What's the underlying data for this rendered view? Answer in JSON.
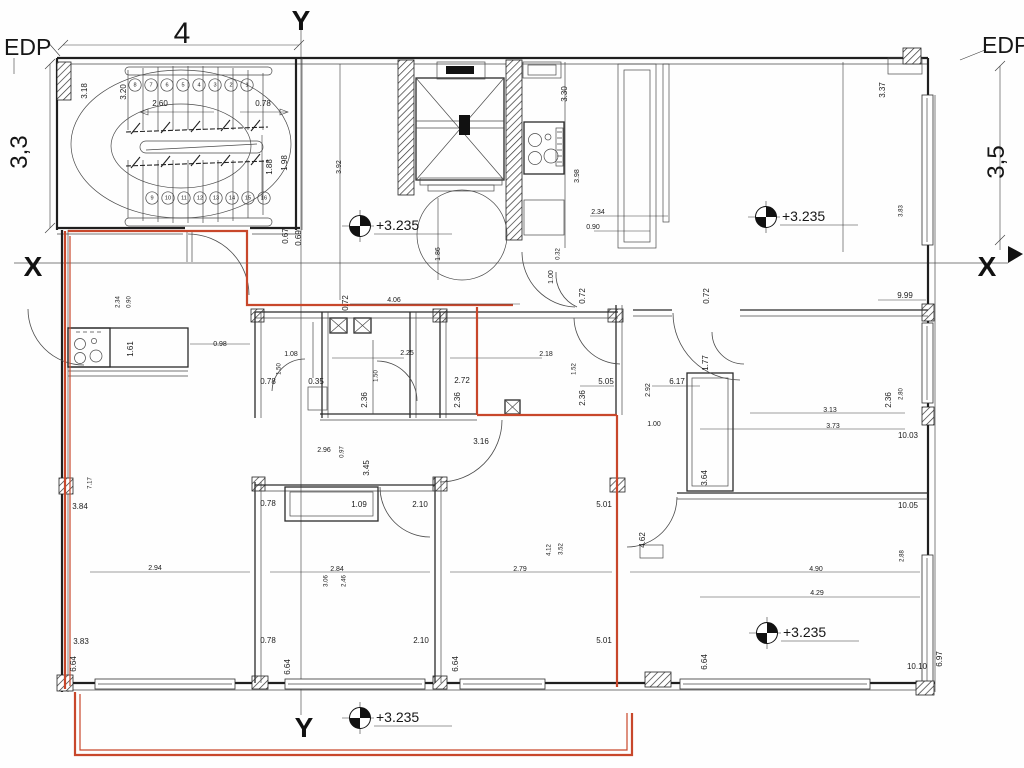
{
  "drawing": {
    "axis": {
      "y_top": "Y",
      "y_bottom": "Y",
      "x_left": "X",
      "x_right": "X"
    },
    "grid": {
      "edp_left": "EDP",
      "edp_right": "EDP",
      "width_top": "4",
      "height_left": "3,3",
      "height_right": "3,5"
    },
    "elevation": {
      "label": "+3.235",
      "markers": [
        [
          360,
          226
        ],
        [
          766,
          217
        ],
        [
          767,
          633
        ],
        [
          360,
          718
        ]
      ]
    },
    "stairs": {
      "top_row": [
        "8",
        "7",
        "6",
        "5",
        "4",
        "3",
        "2",
        "1"
      ],
      "bottom_row": [
        "9",
        "10",
        "11",
        "12",
        "13",
        "14",
        "15",
        "16"
      ]
    },
    "icon_legend": {
      "elevation_marker": "quartered-circle-survey-icon",
      "vent_shaft": "crossed-box-icon",
      "stove": "four-burner-stove-icon"
    },
    "colors": {
      "renovation_red": "#c8472b",
      "wall_black": "#1f1f1f"
    },
    "dimensions": [
      [
        "3.18",
        85,
        91,
        -90,
        8
      ],
      [
        "3.20",
        124,
        92,
        -90,
        8
      ],
      [
        "2.60",
        160,
        104,
        0,
        8
      ],
      [
        "0.78",
        263,
        104,
        0,
        8
      ],
      [
        "1.88",
        270,
        167,
        -90,
        8
      ],
      [
        "1.98",
        285,
        163,
        -90,
        8
      ],
      [
        "0.67",
        286,
        236,
        -90,
        8
      ],
      [
        "0.69",
        299,
        238,
        -90,
        8
      ],
      [
        "3.92",
        339,
        167,
        -90,
        7
      ],
      [
        "1.86",
        438,
        254,
        -90,
        7
      ],
      [
        "3.30",
        565,
        94,
        -90,
        8
      ],
      [
        "3.98",
        577,
        176,
        -90,
        7
      ],
      [
        "2.34",
        598,
        212,
        0,
        7
      ],
      [
        "0.90",
        593,
        227,
        0,
        7
      ],
      [
        "0.32",
        558,
        254,
        -90,
        6
      ],
      [
        "1.00",
        551,
        277,
        -90,
        7
      ],
      [
        "3.37",
        883,
        90,
        -90,
        8
      ],
      [
        "3.83",
        901,
        211,
        -90,
        6
      ],
      [
        "9.99",
        905,
        296,
        0,
        8
      ],
      [
        "0.72",
        346,
        303,
        -90,
        8
      ],
      [
        "4.06",
        394,
        300,
        0,
        7
      ],
      [
        "0.72",
        583,
        296,
        -90,
        8
      ],
      [
        "0.72",
        707,
        296,
        -90,
        8
      ],
      [
        "2.34",
        118,
        302,
        -90,
        6
      ],
      [
        "0.90",
        129,
        302,
        -90,
        6
      ],
      [
        "1.61",
        131,
        349,
        -90,
        8
      ],
      [
        "0.98",
        220,
        344,
        0,
        7
      ],
      [
        "1.08",
        291,
        354,
        0,
        7
      ],
      [
        "1.50",
        279,
        369,
        -90,
        6
      ],
      [
        "0.78",
        268,
        382,
        0,
        8
      ],
      [
        "0.35",
        316,
        382,
        0,
        8
      ],
      [
        "2.25",
        407,
        353,
        0,
        7
      ],
      [
        "1.50",
        376,
        376,
        -90,
        6
      ],
      [
        "2.36",
        365,
        400,
        -90,
        8
      ],
      [
        "2.72",
        462,
        381,
        0,
        8
      ],
      [
        "2.36",
        458,
        400,
        -90,
        8
      ],
      [
        "2.18",
        546,
        354,
        0,
        7
      ],
      [
        "1.52",
        574,
        369,
        -90,
        6
      ],
      [
        "5.05",
        606,
        382,
        0,
        8
      ],
      [
        "2.36",
        583,
        398,
        -90,
        8
      ],
      [
        "2.92",
        648,
        390,
        -90,
        7
      ],
      [
        "6.17",
        677,
        382,
        0,
        8
      ],
      [
        "1.77",
        706,
        363,
        -90,
        8
      ],
      [
        "1.00",
        654,
        424,
        0,
        7
      ],
      [
        "3.13",
        830,
        410,
        0,
        7
      ],
      [
        "3.73",
        833,
        426,
        0,
        7
      ],
      [
        "2.36",
        889,
        400,
        -90,
        8
      ],
      [
        "2.80",
        901,
        394,
        -90,
        6
      ],
      [
        "10.03",
        908,
        436,
        0,
        8
      ],
      [
        "3.16",
        481,
        442,
        0,
        8
      ],
      [
        "2.96",
        324,
        450,
        0,
        7
      ],
      [
        "0.97",
        342,
        452,
        -90,
        6
      ],
      [
        "3.45",
        367,
        468,
        -90,
        8
      ],
      [
        "7.17",
        90,
        483,
        -90,
        6
      ],
      [
        "3.84",
        80,
        507,
        0,
        8
      ],
      [
        "0.78",
        268,
        504,
        0,
        8
      ],
      [
        "1.09",
        359,
        505,
        0,
        8
      ],
      [
        "2.10",
        420,
        505,
        0,
        8
      ],
      [
        "5.01",
        604,
        505,
        0,
        8
      ],
      [
        "3.64",
        705,
        478,
        -90,
        8
      ],
      [
        "10.05",
        908,
        506,
        0,
        8
      ],
      [
        "2.94",
        155,
        568,
        0,
        7
      ],
      [
        "2.84",
        337,
        569,
        0,
        7
      ],
      [
        "3.06",
        326,
        581,
        -90,
        6
      ],
      [
        "2.46",
        344,
        581,
        -90,
        6
      ],
      [
        "2.79",
        520,
        569,
        0,
        7
      ],
      [
        "4.12",
        549,
        550,
        -90,
        6
      ],
      [
        "3.52",
        561,
        549,
        -90,
        6
      ],
      [
        "4.62",
        643,
        540,
        -90,
        8
      ],
      [
        "4.90",
        816,
        569,
        0,
        7
      ],
      [
        "4.29",
        817,
        593,
        0,
        7
      ],
      [
        "2.88",
        902,
        556,
        -90,
        6
      ],
      [
        "3.83",
        81,
        642,
        0,
        8
      ],
      [
        "0.78",
        268,
        641,
        0,
        8
      ],
      [
        "2.10",
        421,
        641,
        0,
        8
      ],
      [
        "5.01",
        604,
        641,
        0,
        8
      ],
      [
        "6.64",
        74,
        664,
        -90,
        8
      ],
      [
        "6.64",
        288,
        667,
        -90,
        8
      ],
      [
        "6.64",
        456,
        664,
        -90,
        8
      ],
      [
        "6.64",
        705,
        662,
        -90,
        8
      ],
      [
        "10.10",
        917,
        667,
        0,
        8
      ],
      [
        "6.97",
        940,
        659,
        -90,
        8
      ]
    ]
  }
}
